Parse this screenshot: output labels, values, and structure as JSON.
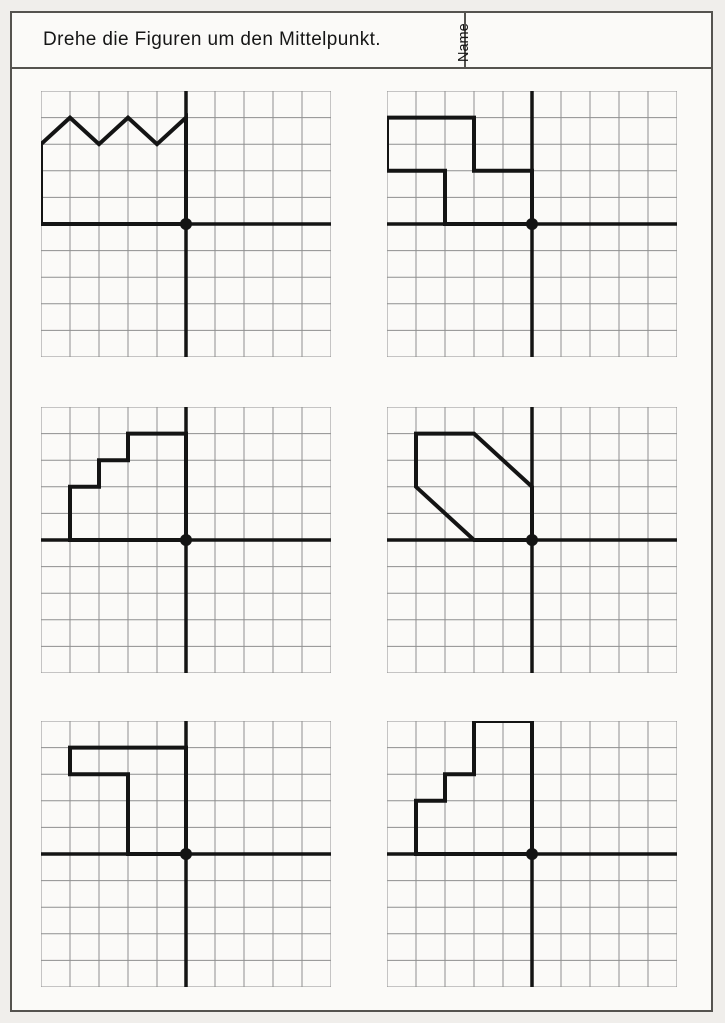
{
  "document": {
    "title": "Drehe die Figuren um den Mittelpunkt.",
    "name_label": "Name"
  },
  "colors": {
    "page_background": "#f0eeeb",
    "sheet_background": "#fbfaf8",
    "border": "#55534f",
    "grid_line": "#8f8f8f",
    "ink": "#141414"
  },
  "grid": {
    "cols": 10,
    "rows": 10,
    "center_col": 5,
    "center_row": 5
  },
  "panels": [
    {
      "id": 1,
      "figure_points": [
        [
          -5,
          0
        ],
        [
          -5,
          3
        ],
        [
          -4,
          4
        ],
        [
          -3,
          3
        ],
        [
          -2,
          4
        ],
        [
          -1,
          3
        ],
        [
          0,
          4
        ],
        [
          0,
          0
        ]
      ]
    },
    {
      "id": 2,
      "figure_points": [
        [
          -5,
          4
        ],
        [
          -2,
          4
        ],
        [
          -2,
          2
        ],
        [
          0,
          2
        ],
        [
          0,
          0
        ],
        [
          -3,
          0
        ],
        [
          -3,
          2
        ],
        [
          -5,
          2
        ]
      ]
    },
    {
      "id": 3,
      "figure_points": [
        [
          -4,
          0
        ],
        [
          -4,
          2
        ],
        [
          -3,
          2
        ],
        [
          -3,
          3
        ],
        [
          -2,
          3
        ],
        [
          -2,
          4
        ],
        [
          0,
          4
        ],
        [
          0,
          0
        ]
      ]
    },
    {
      "id": 4,
      "figure_points": [
        [
          -4,
          4
        ],
        [
          -2,
          4
        ],
        [
          0,
          2
        ],
        [
          0,
          0
        ],
        [
          -2,
          0
        ],
        [
          -4,
          2
        ]
      ]
    },
    {
      "id": 5,
      "figure_points": [
        [
          -4,
          4
        ],
        [
          0,
          4
        ],
        [
          0,
          0
        ],
        [
          -2,
          0
        ],
        [
          -2,
          3
        ],
        [
          -4,
          3
        ]
      ]
    },
    {
      "id": 6,
      "figure_points": [
        [
          -4,
          0
        ],
        [
          -4,
          2
        ],
        [
          -3,
          2
        ],
        [
          -3,
          3
        ],
        [
          -2,
          3
        ],
        [
          -2,
          5
        ],
        [
          0,
          5
        ],
        [
          0,
          0
        ]
      ]
    }
  ]
}
